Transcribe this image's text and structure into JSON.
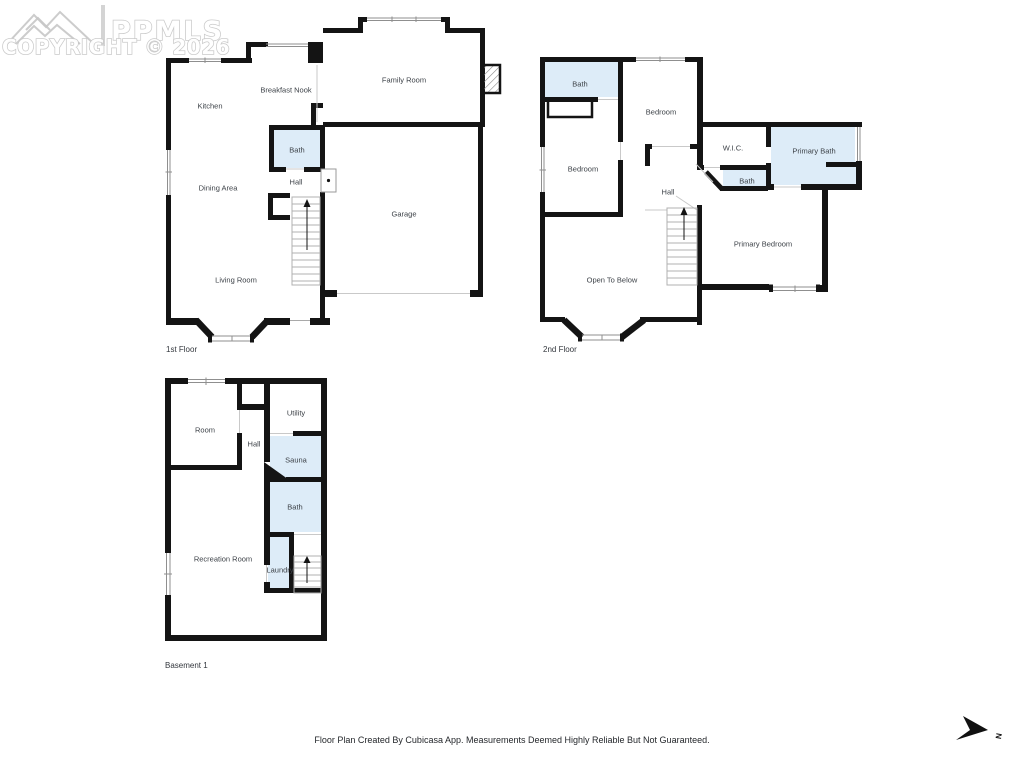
{
  "watermark": {
    "brand": "PPMLS",
    "copyright": "COPYRIGHT © 2026"
  },
  "floors": {
    "first": {
      "label": "1st Floor",
      "rooms": {
        "kitchen": "Kitchen",
        "breakfast_nook": "Breakfast Nook",
        "family_room": "Family Room",
        "bath": "Bath",
        "hall": "Hall",
        "dining_area": "Dining Area",
        "garage": "Garage",
        "living_room": "Living Room"
      }
    },
    "second": {
      "label": "2nd Floor",
      "rooms": {
        "bath": "Bath",
        "bedroom_top": "Bedroom",
        "bedroom_left": "Bedroom",
        "wic": "W.I.C.",
        "primary_bath": "Primary Bath",
        "bath_small": "Bath",
        "hall": "Hall",
        "primary_bedroom": "Primary Bedroom",
        "open_to_below": "Open To Below"
      }
    },
    "basement": {
      "label": "Basement 1",
      "rooms": {
        "room": "Room",
        "utility": "Utility",
        "hall": "Hall",
        "sauna": "Sauna",
        "bath": "Bath",
        "recreation_room": "Recreation Room",
        "laundry": "Laundry"
      }
    }
  },
  "footer": {
    "disclaimer": "Floor Plan Created By Cubicasa App. Measurements Deemed Highly Reliable But Not Guaranteed."
  },
  "compass": {
    "north_label": "N"
  },
  "colors": {
    "wall": "#141414",
    "wet_room_fill": "#ddecf8",
    "label_text": "#3d4248",
    "watermark": "#c7c7c7"
  }
}
